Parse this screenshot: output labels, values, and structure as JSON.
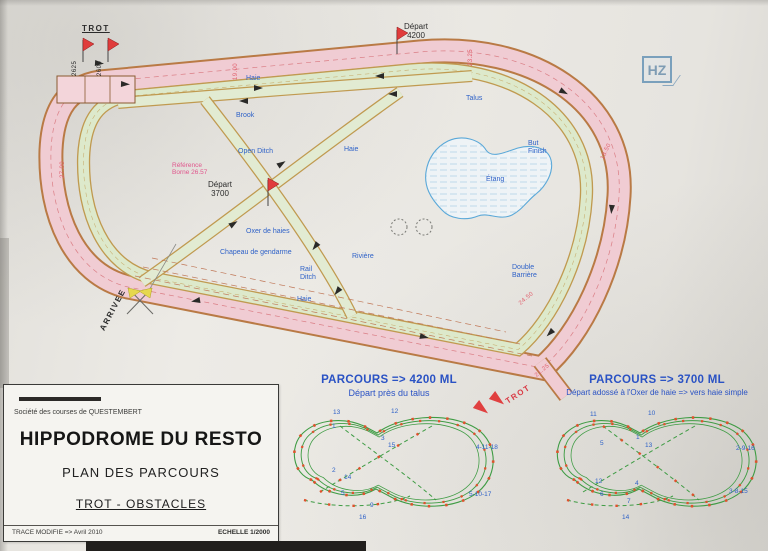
{
  "document": {
    "stamp": "HZ"
  },
  "title_block": {
    "society": "Société des courses de QUESTEMBERT",
    "title": "HIPPODROME DU RESTO",
    "subtitle": "PLAN DES PARCOURS",
    "discipline": "TROT - OBSTACLES",
    "revision": "TRACE MODIFIE  =>  Avril 2010",
    "scale": "ECHELLE 1/2000"
  },
  "plan": {
    "labels_blue": [
      {
        "text": "Haie",
        "x": 246,
        "y": 75,
        "name": "obstacle-haie-top"
      },
      {
        "text": "Talus",
        "x": 466,
        "y": 95,
        "name": "obstacle-talus"
      },
      {
        "text": "Brook",
        "x": 236,
        "y": 112,
        "name": "obstacle-brook"
      },
      {
        "text": "Open Ditch",
        "x": 238,
        "y": 148,
        "name": "obstacle-open-ditch"
      },
      {
        "text": "Haie",
        "x": 344,
        "y": 146,
        "name": "obstacle-haie-diag"
      },
      {
        "text": "Oxer de haies",
        "x": 246,
        "y": 228,
        "name": "obstacle-oxer"
      },
      {
        "text": "Chapeau de gendarme",
        "x": 220,
        "y": 249,
        "name": "obstacle-chapeau"
      },
      {
        "text": "Rivière",
        "x": 352,
        "y": 253,
        "name": "obstacle-riviere"
      },
      {
        "text": "Rail\nDitch",
        "x": 300,
        "y": 266,
        "name": "obstacle-rail-ditch"
      },
      {
        "text": "Haie",
        "x": 297,
        "y": 296,
        "name": "obstacle-haie-bottom"
      },
      {
        "text": "But\nFinish",
        "x": 528,
        "y": 140,
        "name": "but-finish"
      },
      {
        "text": "Double\nBarrière",
        "x": 512,
        "y": 264,
        "name": "obstacle-double-barriere"
      },
      {
        "text": "Étang",
        "x": 486,
        "y": 176,
        "name": "lake-label"
      }
    ],
    "labels_dark": [
      {
        "text": "TROT",
        "x": 82,
        "y": 24,
        "cls": "u sp",
        "name": "trot-start-label"
      },
      {
        "text": "2625",
        "x": 72,
        "y": 76,
        "rot": -90,
        "cls": "tiny",
        "name": "distance-2625"
      },
      {
        "text": "2600",
        "x": 97,
        "y": 76,
        "rot": -90,
        "cls": "tiny",
        "name": "distance-2600"
      },
      {
        "text": "Départ\n4200",
        "x": 404,
        "y": 22,
        "cls": "ctr",
        "name": "depart-4200-label"
      },
      {
        "text": "Départ\n3700",
        "x": 208,
        "y": 180,
        "cls": "ctr",
        "name": "depart-3700-label"
      },
      {
        "text": "ARRIVEE",
        "x": 98,
        "y": 328,
        "rot": -62,
        "cls": "sp",
        "name": "arrivee-label"
      }
    ],
    "labels_red": [
      {
        "text": "TROT",
        "x": 504,
        "y": 398,
        "rot": -33,
        "cls": "sp",
        "name": "trot-chute-label"
      },
      {
        "text": "Référence\nBorne 26.57",
        "x": 172,
        "y": 162,
        "cls": "magenta",
        "name": "reference-borne"
      }
    ],
    "distance_marks": [
      {
        "text": "19.00",
        "x": 233,
        "y": 80,
        "rot": -90
      },
      {
        "text": "23.25",
        "x": 468,
        "y": 66,
        "rot": -90
      },
      {
        "text": "18.50",
        "x": 600,
        "y": 158,
        "rot": -65
      },
      {
        "text": "24.50",
        "x": 518,
        "y": 302,
        "rot": -40
      },
      {
        "text": "27.00",
        "x": 60,
        "y": 178,
        "rot": -90
      },
      {
        "text": "21.25",
        "x": 534,
        "y": 374,
        "rot": -40
      }
    ]
  },
  "parcours_4200": {
    "title": "PARCOURS => 4200 ML",
    "subtitle": "Départ près du talus",
    "numbers": [
      {
        "text": "13",
        "x": 333,
        "y": 409
      },
      {
        "text": "12",
        "x": 391,
        "y": 408
      },
      {
        "text": "1",
        "x": 332,
        "y": 423
      },
      {
        "text": "3",
        "x": 381,
        "y": 435
      },
      {
        "text": "15",
        "x": 388,
        "y": 442
      },
      {
        "text": "2",
        "x": 332,
        "y": 467
      },
      {
        "text": "14",
        "x": 344,
        "y": 474
      },
      {
        "text": "5",
        "x": 341,
        "y": 490
      },
      {
        "text": "9",
        "x": 370,
        "y": 502
      },
      {
        "text": "16",
        "x": 359,
        "y": 514
      },
      {
        "text": "4-11-18",
        "x": 476,
        "y": 444
      },
      {
        "text": "5-10-17",
        "x": 469,
        "y": 491
      }
    ]
  },
  "parcours_3700": {
    "title": "PARCOURS => 3700 ML",
    "subtitle": "Départ adossé à l'Oxer de haie => vers haie simple",
    "numbers": [
      {
        "text": "11",
        "x": 590,
        "y": 411
      },
      {
        "text": "10",
        "x": 648,
        "y": 410
      },
      {
        "text": "5",
        "x": 600,
        "y": 440
      },
      {
        "text": "1",
        "x": 636,
        "y": 434
      },
      {
        "text": "13",
        "x": 645,
        "y": 442
      },
      {
        "text": "12",
        "x": 595,
        "y": 478
      },
      {
        "text": "4",
        "x": 635,
        "y": 480
      },
      {
        "text": "6",
        "x": 600,
        "y": 491
      },
      {
        "text": "7",
        "x": 627,
        "y": 498
      },
      {
        "text": "14",
        "x": 622,
        "y": 514
      },
      {
        "text": "2-9-16",
        "x": 736,
        "y": 445
      },
      {
        "text": "3-8-15",
        "x": 729,
        "y": 488
      }
    ]
  }
}
